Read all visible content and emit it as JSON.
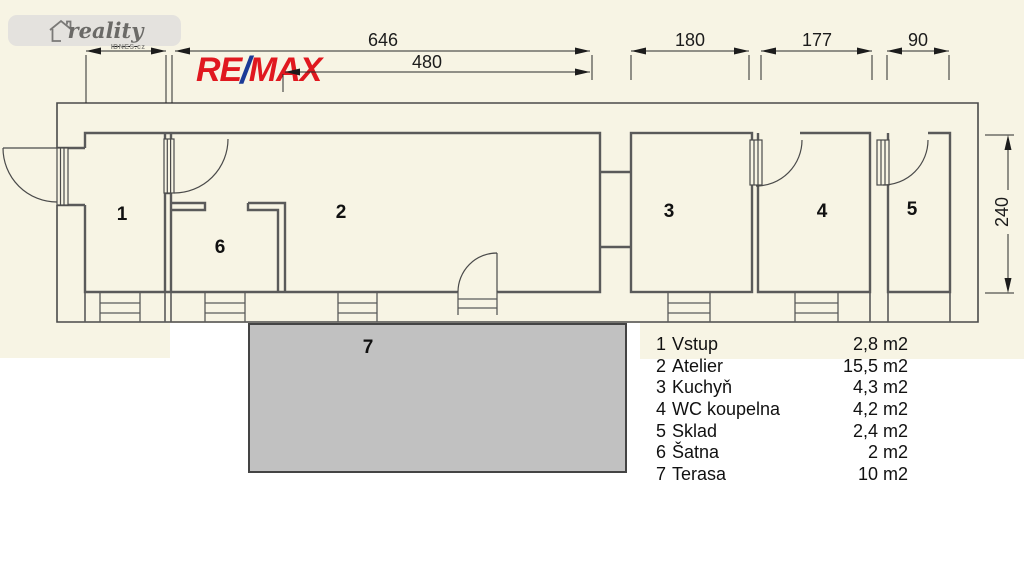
{
  "watermark": {
    "brand": "reality",
    "suffix": "IDNES.cz"
  },
  "agency_logo": {
    "re": "RE",
    "slash": "/",
    "max": "MAX"
  },
  "dims": {
    "w120": "120",
    "w646": "646",
    "w480": "480",
    "w180": "180",
    "w177": "177",
    "w90": "90",
    "h240": "240"
  },
  "rooms": [
    {
      "num": "1",
      "name": "Vstup",
      "area": "2,8 m2"
    },
    {
      "num": "2",
      "name": "Atelier",
      "area": "15,5 m2"
    },
    {
      "num": "3",
      "name": "Kuchyň",
      "area": "4,3 m2"
    },
    {
      "num": "4",
      "name": "WC koupelna",
      "area": "4,2 m2"
    },
    {
      "num": "5",
      "name": "Sklad",
      "area": "2,4 m2"
    },
    {
      "num": "6",
      "name": "Šatna",
      "area": "2 m2"
    },
    {
      "num": "7",
      "name": "Terasa",
      "area": "10 m2"
    }
  ],
  "colors": {
    "background": "#f7f4e4",
    "wall": "#555555",
    "terrace_fill": "#c1c1c1",
    "remax_red": "#e0181f",
    "remax_blue": "#1b3a97"
  }
}
